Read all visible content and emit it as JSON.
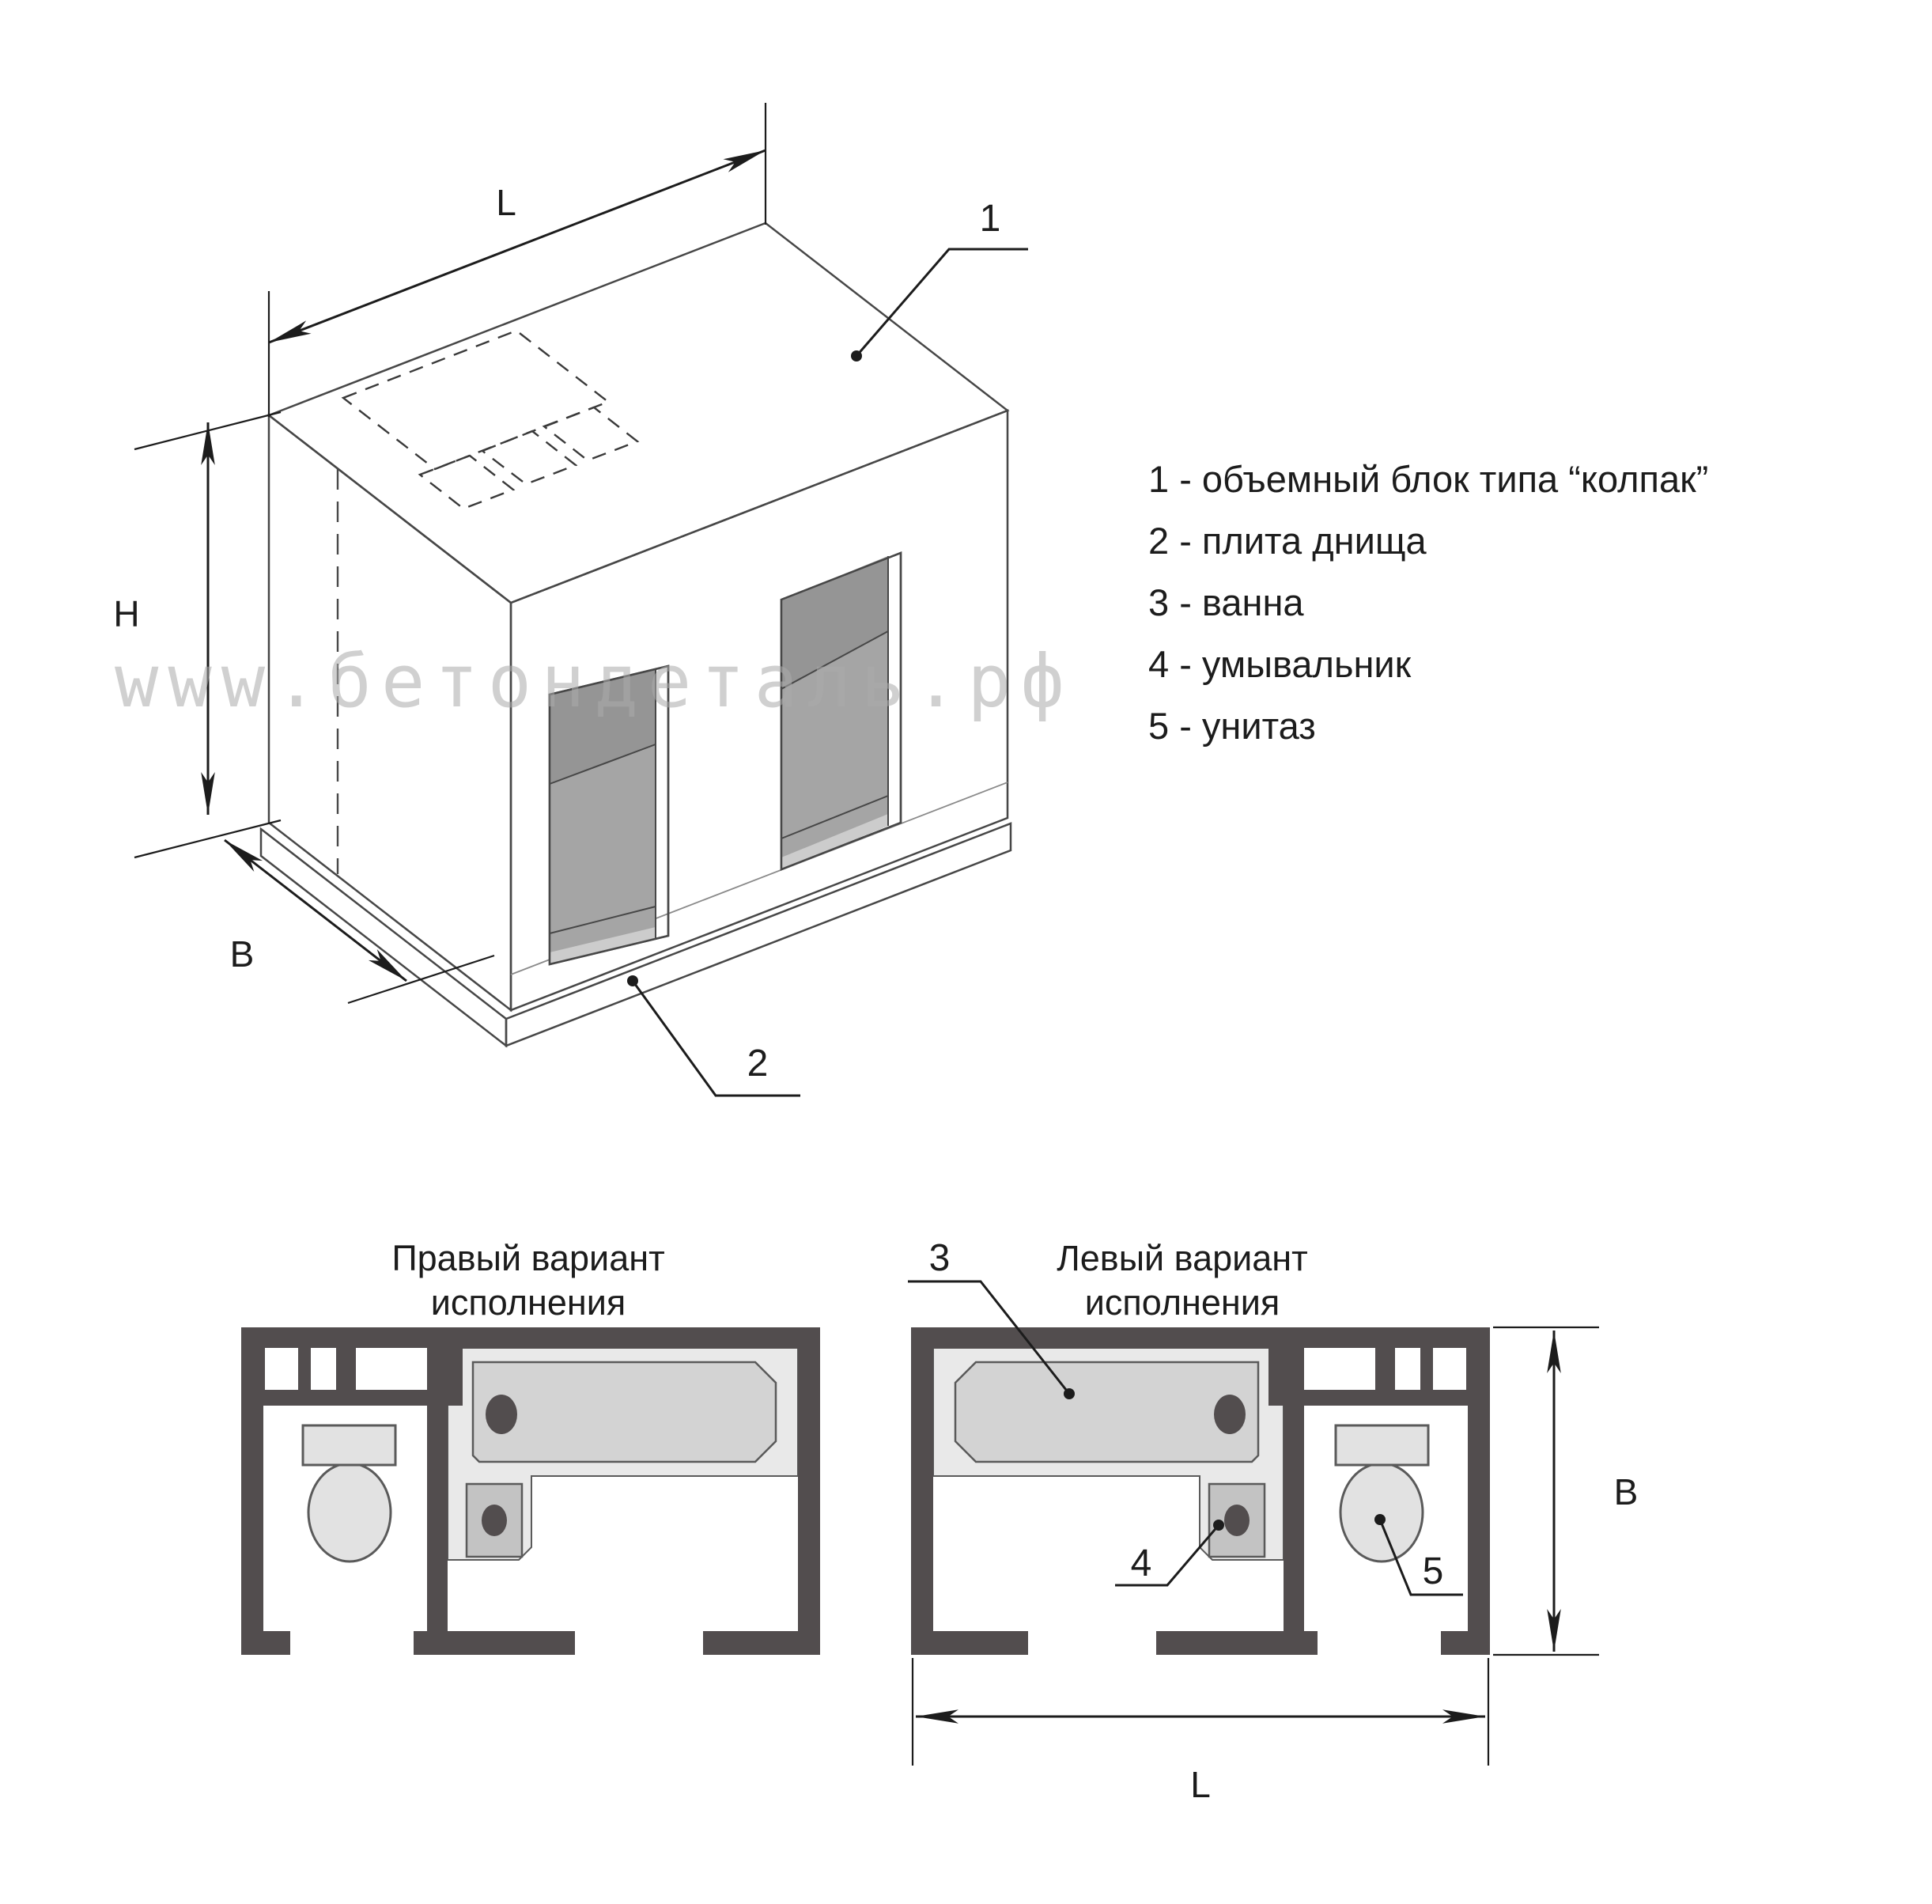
{
  "watermark_text": "www.бетондеталь.рф",
  "dimensions": {
    "length": "L",
    "height": "H",
    "width": "B"
  },
  "legend": {
    "items": [
      {
        "num": "1",
        "text": "1 - объемный блок типа “колпак”"
      },
      {
        "num": "2",
        "text": "2 - плита днища"
      },
      {
        "num": "3",
        "text": "3 - ванна"
      },
      {
        "num": "4",
        "text": "4 - умывальник"
      },
      {
        "num": "5",
        "text": "5 - унитаз"
      }
    ]
  },
  "plans": {
    "right_variant": {
      "title_line1": "Правый вариант",
      "title_line2": "исполнения"
    },
    "left_variant": {
      "title_line1": "Левый вариант",
      "title_line2": "исполнения"
    }
  },
  "colors": {
    "wall": "#524d4e",
    "box_top_face": "#d2d2d2",
    "box_side_face": "#c5c5c5",
    "box_front_face": "#dbdbdb",
    "door_opening": "#a5a5a5",
    "bath_fill": "#d3d3d3",
    "fixture_fill": "#e2e2e2",
    "sink_fill": "#c3c3c3",
    "surround_fill": "#e9e9e9",
    "base_plate": "#e0e0e0",
    "line": "#1c1c1c",
    "watermark": "#ababab"
  }
}
